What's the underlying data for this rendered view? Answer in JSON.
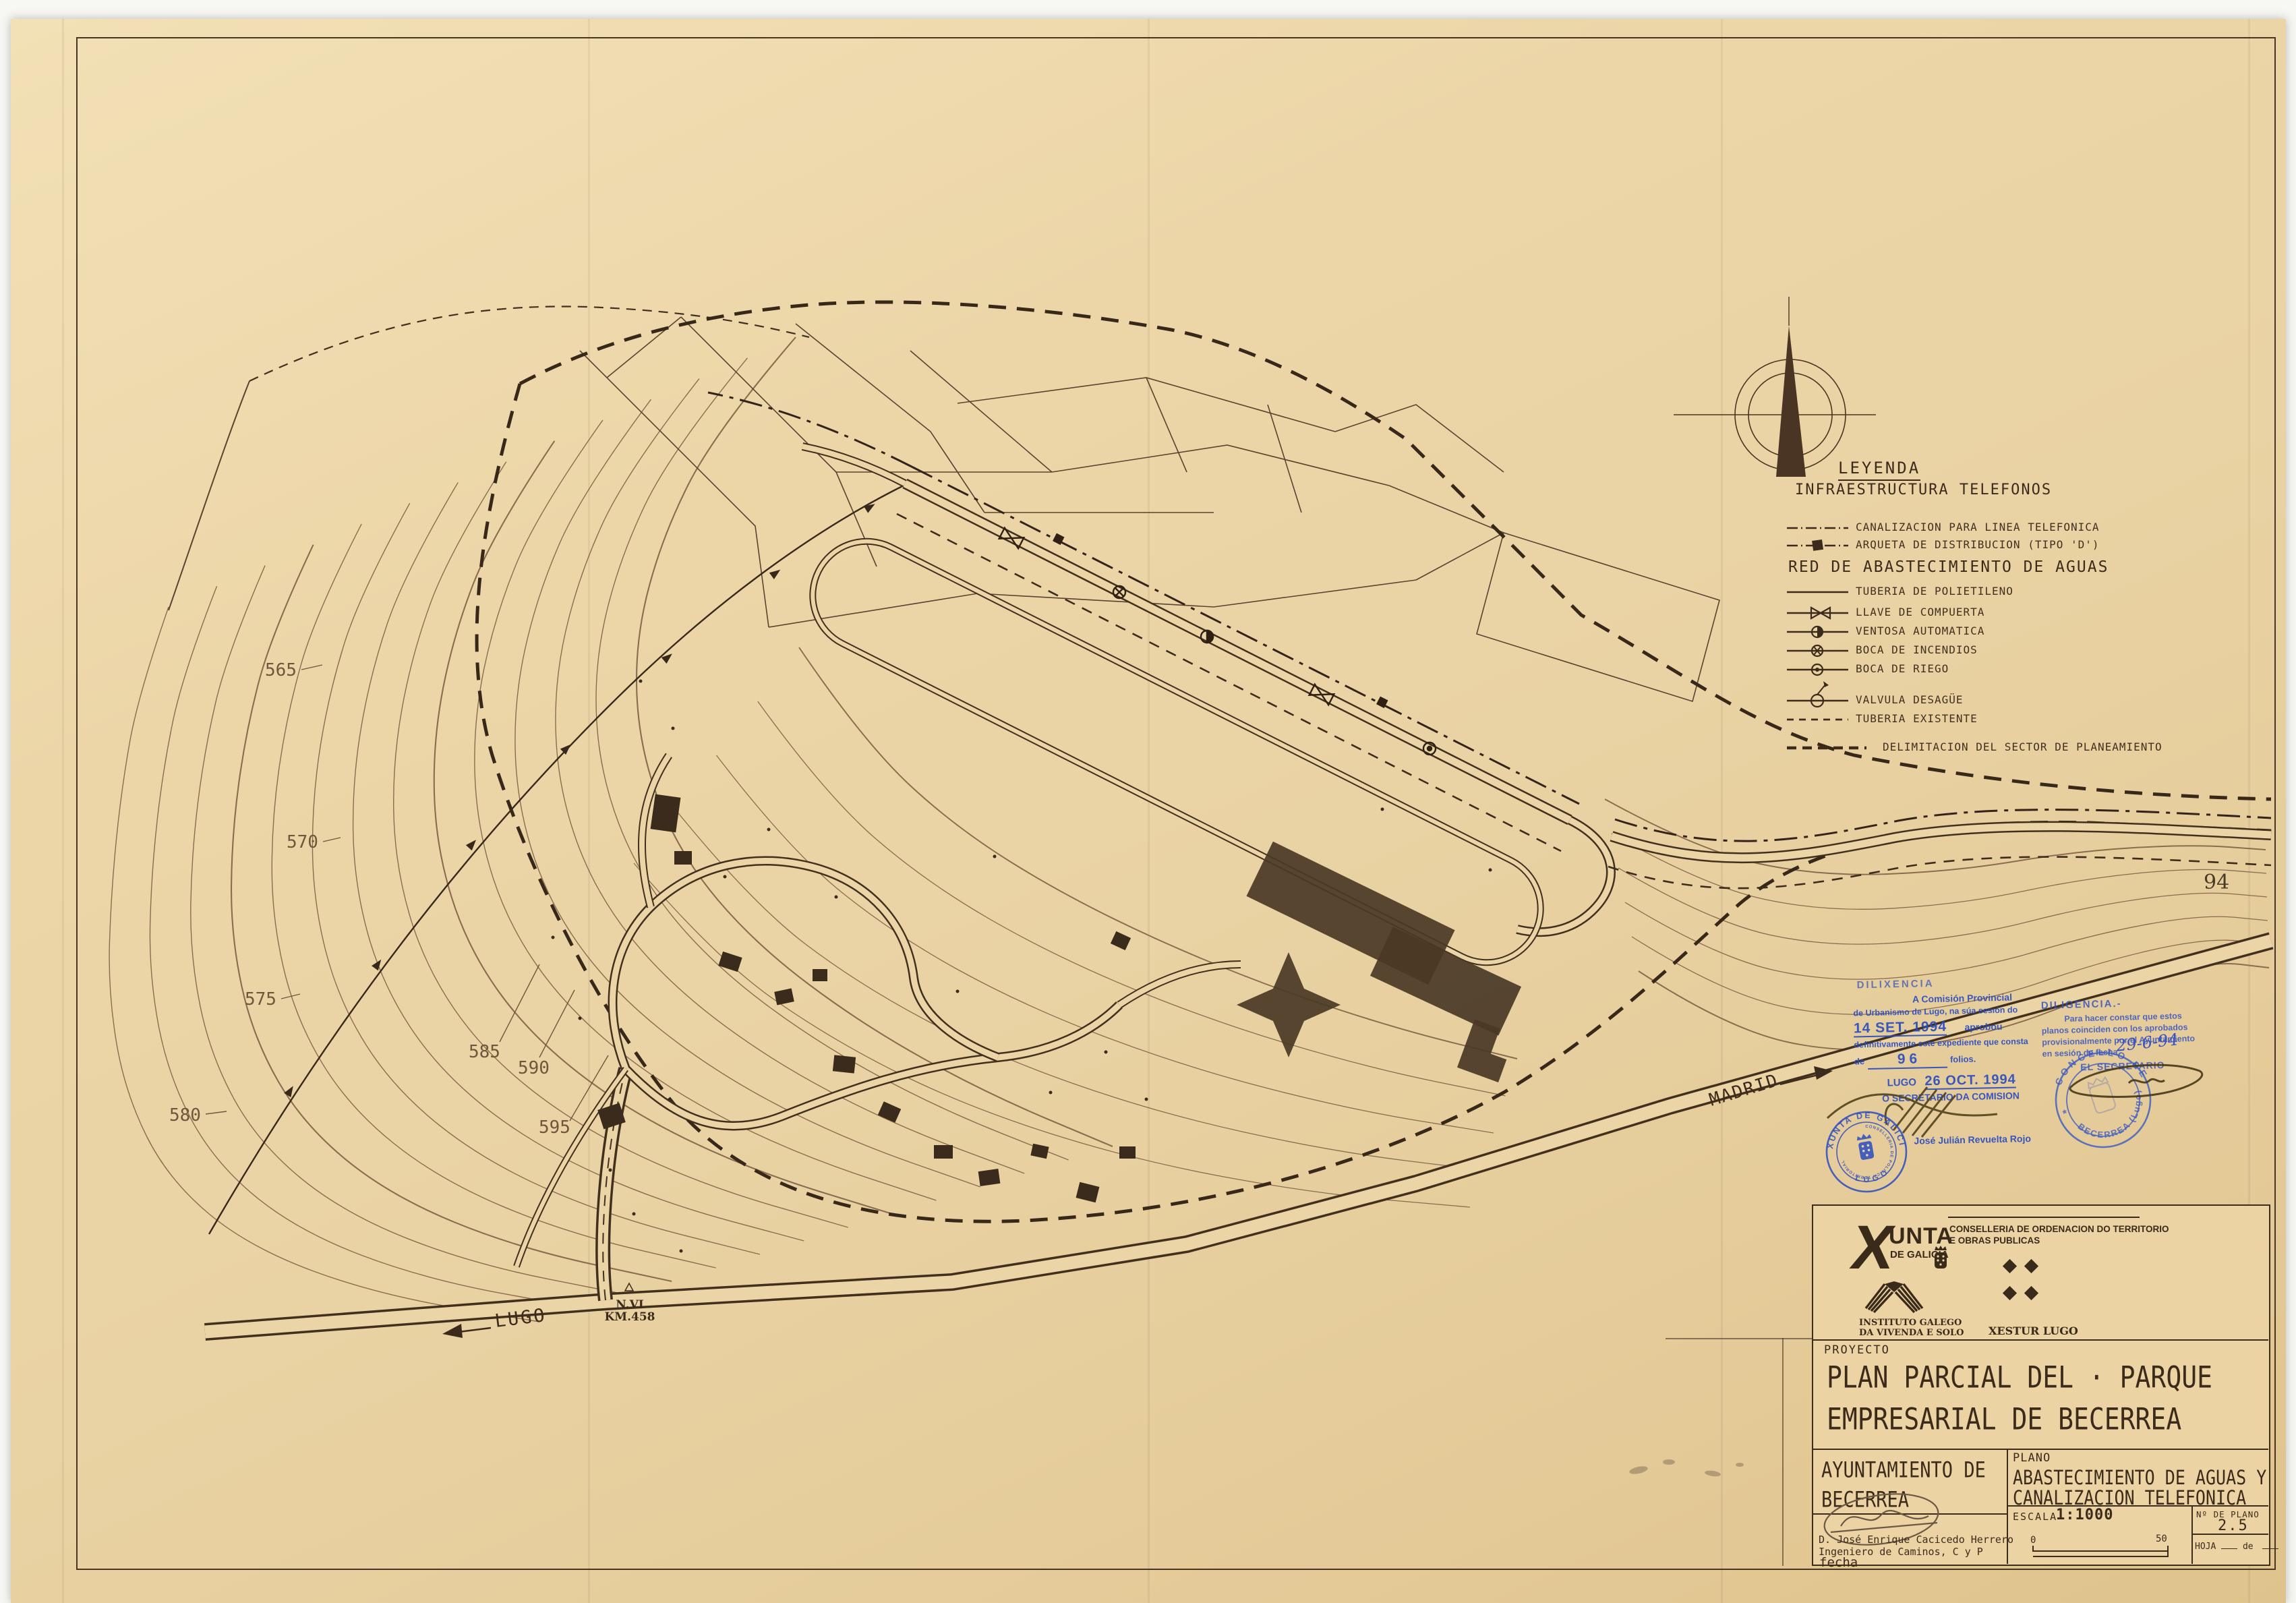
{
  "colors": {
    "paper": "#ebd3a4",
    "ink": "#3c2b1b",
    "stamp_blue": "#2a4cc0"
  },
  "sheet": {
    "page_number": "94"
  },
  "legend": {
    "title": "LEYENDA",
    "telefonos_header": "INFRAESTRUCTURA TELEFONOS",
    "telefonos_items": [
      {
        "label": "CANALIZACION PARA LINEA TELEFONICA",
        "symbol": "dash-dot-line"
      },
      {
        "label": "ARQUETA DE DISTRIBUCION (TIPO 'D')",
        "symbol": "dash-dot-line-hatched-box"
      }
    ],
    "aguas_header": "RED DE ABASTECIMIENTO DE AGUAS",
    "aguas_items": [
      {
        "label": "TUBERIA DE POLIETILENO",
        "symbol": "solid-line"
      },
      {
        "label": "LLAVE DE COMPUERTA",
        "symbol": "gate-valve"
      },
      {
        "label": "VENTOSA AUTOMATICA",
        "symbol": "half-filled-circle"
      },
      {
        "label": "BOCA DE INCENDIOS",
        "symbol": "circle-cross"
      },
      {
        "label": "BOCA DE RIEGO",
        "symbol": "circle-dot"
      },
      {
        "label": "VALVULA DESAGÜE",
        "symbol": "drain-valve"
      },
      {
        "label": "TUBERIA EXISTENTE",
        "symbol": "dashed-line"
      }
    ],
    "delimitacion_item": {
      "label": "DELIMITACION DEL SECTOR DE PLANEAMIENTO",
      "symbol": "bold-dashed-line"
    }
  },
  "map_labels": {
    "contours": [
      "565",
      "570",
      "575",
      "580",
      "585",
      "590",
      "595"
    ],
    "lugo": "LUGO",
    "nvi": "N.VI",
    "km": "KM.458",
    "madrid": "MADRID"
  },
  "stamps": {
    "dilixencia": {
      "heading": "DILIXENCIA",
      "line1": "A Comisión Provincial",
      "line2": "de Urbanismo de Lugo, na súa sesión do",
      "date1": "14 SET. 1994",
      "aprobou": "aprobou",
      "line3": "definitivamente este expediente que consta",
      "de": "de",
      "folios_num": "9 6",
      "folios": "folios.",
      "lugo": "LUGO",
      "date2": "26 OCT. 1994",
      "secretario": "O SECRETARIO DA COMISION",
      "firmante": "José Julián Revuelta Rojo",
      "seal_top": "XUNTA DE GALICIA",
      "seal_middle": "CONSELLERIA DE POLITICA TERRITORIAL",
      "seal_bottom": "LUGO"
    },
    "diligencia": {
      "heading": "DILIGENCIA.-",
      "line1": "Para hacer constar que estos",
      "line2": "planos coinciden con los aprobados",
      "line3": "provisionalmente por el Ayuntamiento",
      "line4": "en sesión de fecha",
      "fecha_manuscrita": "29-6-94",
      "secretario": "EL SECRETARIO",
      "seal_top": "CONCELLO DE",
      "seal_bottom": "BECERREA (Lugo)"
    }
  },
  "title_block": {
    "xunta_x": "X",
    "xunta_rest": "UNTA",
    "xunta_sub": "DE GALICIA",
    "conselleria_line1": "CONSELLERIA DE ORDENACION DO TERRITORIO",
    "conselleria_line2": "E OBRAS PUBLICAS",
    "instituto_line1": "INSTITUTO GALEGO",
    "instituto_line2": "DA VIVENDA E SOLO",
    "xestur": "XESTUR LUGO",
    "proyecto_label": "PROYECTO",
    "proyecto_line1": "PLAN PARCIAL DEL · PARQUE",
    "proyecto_line2": "EMPRESARIAL DE BECERREA",
    "ayuntamiento_line1": "AYUNTAMIENTO DE",
    "ayuntamiento_line2": "BECERREA",
    "plano_label": "PLANO",
    "plano_line1": "ABASTECIMIENTO DE AGUAS Y",
    "plano_line2": "CANALIZACION TELEFONICA",
    "engineer_name": "D. José Enrique Cacicedo Herrero",
    "engineer_title": "Ingeniero de Caminos, C y P",
    "fecha_label": "fecha",
    "escala_label": "ESCALA",
    "escala_value": "1:1000",
    "scale_zero": "0",
    "scale_fifty": "50",
    "num_plano_label": "Nº DE PLANO",
    "num_plano_value": "2.5",
    "hoja_label": "HOJA",
    "hoja_de": "de"
  }
}
